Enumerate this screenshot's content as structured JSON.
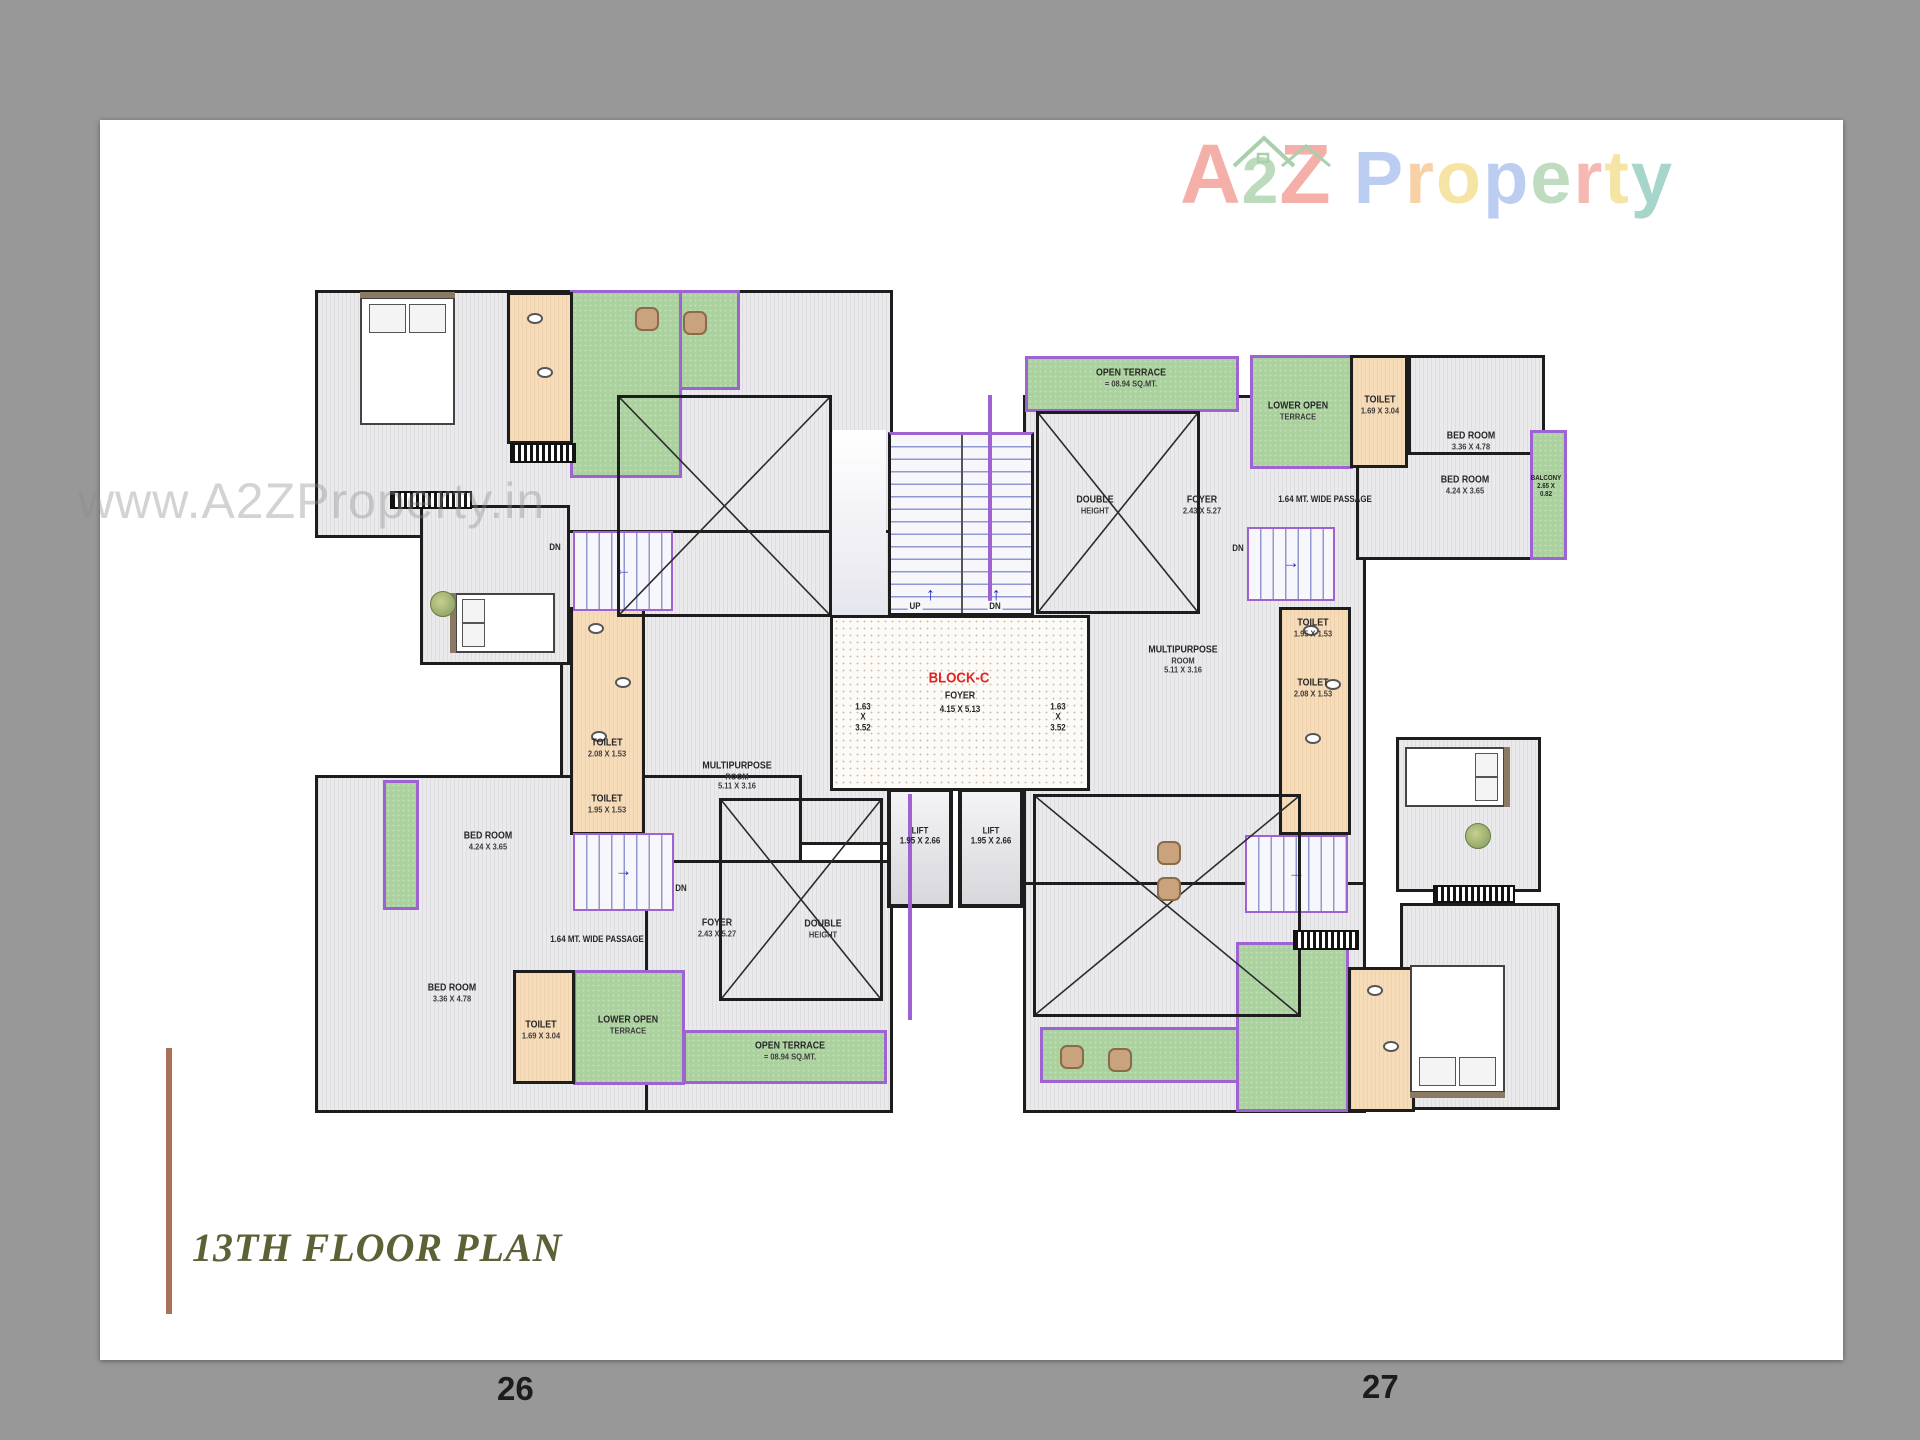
{
  "page": {
    "watermark": "www.A2ZProperty.in",
    "title": "13TH FLOOR PLAN",
    "page_number_left": "26",
    "page_number_right": "27",
    "title_color": "#5d6135",
    "accent_line_color": "#a8715a",
    "logo": {
      "word1": [
        {
          "ch": "A",
          "c": "#f4afa9"
        },
        {
          "ch": "2",
          "c": "#bcdabd",
          "mid": true
        },
        {
          "ch": "Z",
          "c": "#f4afa9"
        }
      ],
      "word2": [
        {
          "ch": "P",
          "c": "#bccdf2"
        },
        {
          "ch": "r",
          "c": "#f8d2a6"
        },
        {
          "ch": "o",
          "c": "#f6e4a4"
        },
        {
          "ch": "p",
          "c": "#bccdf2"
        },
        {
          "ch": "e",
          "c": "#bfdcc0"
        },
        {
          "ch": "r",
          "c": "#f6b8b3"
        },
        {
          "ch": "t",
          "c": "#f6e4a4"
        },
        {
          "ch": "y",
          "c": "#a6d5cb"
        }
      ],
      "house_color": "#aacfab"
    }
  },
  "plan": {
    "block_name": "BLOCK-C",
    "accent_purple": "#9e63d3",
    "red": "#e02420",
    "regions": [
      {
        "n": "unit-a-floor",
        "t": "floor",
        "x": 10,
        "y": 5,
        "w": 578,
        "h": 248
      },
      {
        "n": "unit-c-upper-floor",
        "t": "floor",
        "x": 255,
        "y": 245,
        "w": 335,
        "h": 315
      },
      {
        "n": "unit-c-floor",
        "t": "floor",
        "x": 10,
        "y": 490,
        "w": 487,
        "h": 338
      },
      {
        "n": "unit-c-east-floor",
        "t": "floor",
        "x": 340,
        "y": 575,
        "w": 248,
        "h": 253
      },
      {
        "n": "unit-b-floor",
        "t": "floor",
        "x": 718,
        "y": 110,
        "w": 343,
        "h": 492
      },
      {
        "n": "unit-d-floor",
        "t": "floor",
        "x": 718,
        "y": 597,
        "w": 343,
        "h": 231
      },
      {
        "n": "bedroom-424-b-floor",
        "t": "floor",
        "x": 1051,
        "y": 150,
        "w": 178,
        "h": 125
      },
      {
        "n": "bedroom-336-b-floor",
        "t": "floor",
        "x": 1103,
        "y": 70,
        "w": 137,
        "h": 100
      },
      {
        "n": "unit-d-bedroom-floor",
        "t": "floor",
        "x": 1095,
        "y": 618,
        "w": 160,
        "h": 207
      },
      {
        "n": "unit-d-mid-bedroom-floor",
        "t": "floor",
        "x": 1091,
        "y": 452,
        "w": 145,
        "h": 155
      },
      {
        "n": "unit-a-mid-bedroom-floor",
        "t": "floor",
        "x": 115,
        "y": 220,
        "w": 150,
        "h": 160
      },
      {
        "n": "terrace-a-band",
        "t": "terrace",
        "x": 265,
        "y": 5,
        "w": 170,
        "h": 100
      },
      {
        "n": "terrace-a-block",
        "t": "terrace",
        "x": 265,
        "y": 5,
        "w": 112,
        "h": 188
      },
      {
        "n": "open-terrace-b",
        "t": "terrace",
        "x": 720,
        "y": 71,
        "w": 214,
        "h": 56
      },
      {
        "n": "lower-open-terrace-b",
        "t": "terrace",
        "x": 945,
        "y": 70,
        "w": 103,
        "h": 114
      },
      {
        "n": "balcony-b",
        "t": "terrace",
        "x": 1225,
        "y": 145,
        "w": 37,
        "h": 130
      },
      {
        "n": "lower-open-terrace-c",
        "t": "terrace",
        "x": 268,
        "y": 685,
        "w": 112,
        "h": 115
      },
      {
        "n": "open-terrace-c",
        "t": "terrace",
        "x": 378,
        "y": 745,
        "w": 204,
        "h": 54
      },
      {
        "n": "terrace-d-band",
        "t": "terrace",
        "x": 735,
        "y": 742,
        "w": 202,
        "h": 56
      },
      {
        "n": "terrace-d-block",
        "t": "terrace",
        "x": 931,
        "y": 657,
        "w": 113,
        "h": 170
      },
      {
        "n": "balcony-c",
        "t": "terrace",
        "x": 78,
        "y": 495,
        "w": 36,
        "h": 130
      },
      {
        "n": "toilet-strip-a",
        "t": "toilet",
        "x": 202,
        "y": 7,
        "w": 66,
        "h": 152
      },
      {
        "n": "toilet-column-west",
        "t": "toilet",
        "x": 265,
        "y": 322,
        "w": 75,
        "h": 228
      },
      {
        "n": "toilet-column-east",
        "t": "toilet",
        "x": 974,
        "y": 322,
        "w": 72,
        "h": 228
      },
      {
        "n": "toilet-169-b",
        "t": "toilet",
        "x": 1045,
        "y": 70,
        "w": 58,
        "h": 113
      },
      {
        "n": "toilet-strip-d",
        "t": "toilet",
        "x": 1043,
        "y": 682,
        "w": 67,
        "h": 145
      },
      {
        "n": "toilet-169-c",
        "t": "toilet",
        "x": 208,
        "y": 685,
        "w": 62,
        "h": 114
      },
      {
        "n": "stair-landing",
        "t": "landing",
        "x": 527,
        "y": 145,
        "w": 54,
        "h": 184
      },
      {
        "n": "block-c-foyer",
        "t": "foyer",
        "x": 525,
        "y": 330,
        "w": 260,
        "h": 176
      },
      {
        "n": "central-staircase",
        "t": "stair-core",
        "x": 583,
        "y": 147,
        "w": 146,
        "h": 184
      },
      {
        "n": "lift-1",
        "t": "lift",
        "x": 582,
        "y": 503,
        "w": 66,
        "h": 120
      },
      {
        "n": "lift-2",
        "t": "lift",
        "x": 653,
        "y": 503,
        "w": 66,
        "h": 120
      },
      {
        "n": "stairs-a",
        "t": "stair",
        "x": 268,
        "y": 246,
        "w": 100,
        "h": 80,
        "dir": "left"
      },
      {
        "n": "stairs-b",
        "t": "stair",
        "x": 942,
        "y": 242,
        "w": 88,
        "h": 74,
        "dir": "right"
      },
      {
        "n": "stairs-c",
        "t": "stair",
        "x": 268,
        "y": 548,
        "w": 101,
        "h": 78,
        "dir": "right"
      },
      {
        "n": "stairs-d",
        "t": "stair",
        "x": 940,
        "y": 550,
        "w": 103,
        "h": 78,
        "dir": "right"
      },
      {
        "n": "double-height-a",
        "t": "cross",
        "x": 312,
        "y": 110,
        "w": 215,
        "h": 222
      },
      {
        "n": "double-height-b",
        "t": "cross",
        "x": 731,
        "y": 126,
        "w": 164,
        "h": 203
      },
      {
        "n": "double-height-c",
        "t": "cross",
        "x": 414,
        "y": 513,
        "w": 164,
        "h": 203
      },
      {
        "n": "double-height-d",
        "t": "cross",
        "x": 728,
        "y": 509,
        "w": 268,
        "h": 223
      },
      {
        "n": "purple-wall-1",
        "t": "pline",
        "x": 683,
        "y": 110,
        "w": 4,
        "h": 206
      },
      {
        "n": "purple-wall-2",
        "t": "pline",
        "x": 603,
        "y": 509,
        "w": 4,
        "h": 226
      }
    ],
    "labels": [
      {
        "n": "open-terrace-b-label",
        "x": 826,
        "y": 93,
        "lines": [
          "OPEN TERRACE",
          "= 08.94 SQ.MT."
        ]
      },
      {
        "n": "lower-open-terrace-b-label",
        "x": 993,
        "y": 126,
        "lines": [
          "LOWER OPEN",
          "TERRACE"
        ]
      },
      {
        "n": "toilet-169-b-label",
        "x": 1075,
        "y": 120,
        "lines": [
          "TOILET",
          "1.69 X 3.04"
        ]
      },
      {
        "n": "bedroom-336-b-label",
        "x": 1166,
        "y": 156,
        "lines": [
          "BED ROOM",
          "3.36 X 4.78"
        ]
      },
      {
        "n": "passage-b-label",
        "x": 1020,
        "y": 214,
        "lines": [
          "1.64 MT. WIDE PASSAGE"
        ],
        "s": 9
      },
      {
        "n": "double-height-b-label",
        "x": 790,
        "y": 220,
        "lines": [
          "DOUBLE",
          "HEIGHT"
        ]
      },
      {
        "n": "foyer-b-label",
        "x": 897,
        "y": 220,
        "lines": [
          "FOYER",
          "2.43 X 5.27"
        ]
      },
      {
        "n": "dn-b-label",
        "x": 933,
        "y": 263,
        "lines": [
          "DN"
        ],
        "s": 9
      },
      {
        "n": "bedroom-424-b-label",
        "x": 1160,
        "y": 200,
        "lines": [
          "BED ROOM",
          "4.24 X 3.65"
        ]
      },
      {
        "n": "balcony-b-label",
        "x": 1241,
        "y": 202,
        "lines": [
          "BALCONY",
          "2.65 X",
          "0.82"
        ],
        "s": 7
      },
      {
        "n": "toilet-195-b-label",
        "x": 1008,
        "y": 343,
        "lines": [
          "TOILET",
          "1.95 X 1.53"
        ]
      },
      {
        "n": "toilet-208-b-label",
        "x": 1008,
        "y": 403,
        "lines": [
          "TOILET",
          "2.08 X 1.53"
        ]
      },
      {
        "n": "multipurpose-b-label",
        "x": 878,
        "y": 375,
        "lines": [
          "MULTIPURPOSE",
          "ROOM",
          "5.11 X 3.16"
        ]
      },
      {
        "n": "dim-163-east-label",
        "x": 753,
        "y": 432,
        "lines": [
          "1.63",
          "X",
          "3.52"
        ],
        "s": 9
      },
      {
        "n": "dim-163-west-label",
        "x": 558,
        "y": 432,
        "lines": [
          "1.63",
          "X",
          "3.52"
        ],
        "s": 9
      },
      {
        "n": "block-c-label",
        "x": 654,
        "y": 393,
        "lines": [
          "BLOCK-C"
        ],
        "c": "#e02420",
        "s": 15
      },
      {
        "n": "block-c-foyer-label",
        "x": 655,
        "y": 411,
        "lines": [
          "FOYER"
        ]
      },
      {
        "n": "block-c-dim-label",
        "x": 655,
        "y": 424,
        "lines": [
          "4.15 X 5.13"
        ],
        "s": 9
      },
      {
        "n": "lift-1-label",
        "x": 615,
        "y": 551,
        "lines": [
          "LIFT",
          "1.95 X 2.66"
        ],
        "s": 9
      },
      {
        "n": "lift-2-label",
        "x": 686,
        "y": 551,
        "lines": [
          "LIFT",
          "1.95 X 2.66"
        ],
        "s": 9
      },
      {
        "n": "up-label",
        "x": 610,
        "y": 321,
        "lines": [
          "UP"
        ],
        "s": 9,
        "chip": 1
      },
      {
        "n": "dn-core-label",
        "x": 690,
        "y": 321,
        "lines": [
          "DN"
        ],
        "s": 9,
        "chip": 1
      },
      {
        "n": "toilet-208-c-label",
        "x": 302,
        "y": 463,
        "lines": [
          "TOILET",
          "2.08 X 1.53"
        ]
      },
      {
        "n": "toilet-195-c-label",
        "x": 302,
        "y": 519,
        "lines": [
          "TOILET",
          "1.95 X 1.53"
        ]
      },
      {
        "n": "multipurpose-c-label",
        "x": 432,
        "y": 491,
        "lines": [
          "MULTIPURPOSE",
          "ROOM",
          "5.11 X 3.16"
        ]
      },
      {
        "n": "bedroom-424-c-label",
        "x": 183,
        "y": 556,
        "lines": [
          "BED ROOM",
          "4.24 X 3.65"
        ]
      },
      {
        "n": "dn-c-label",
        "x": 376,
        "y": 603,
        "lines": [
          "DN"
        ],
        "s": 9
      },
      {
        "n": "passage-c-label",
        "x": 292,
        "y": 654,
        "lines": [
          "1.64 MT. WIDE PASSAGE"
        ],
        "s": 9
      },
      {
        "n": "bedroom-336-c-label",
        "x": 147,
        "y": 708,
        "lines": [
          "BED ROOM",
          "3.36 X 4.78"
        ]
      },
      {
        "n": "toilet-169-c-label",
        "x": 236,
        "y": 745,
        "lines": [
          "TOILET",
          "1.69 X 3.04"
        ]
      },
      {
        "n": "lower-open-terrace-c-label",
        "x": 323,
        "y": 740,
        "lines": [
          "LOWER OPEN",
          "TERRACE"
        ]
      },
      {
        "n": "foyer-c-label",
        "x": 412,
        "y": 643,
        "lines": [
          "FOYER",
          "2.43 X 5.27"
        ]
      },
      {
        "n": "double-height-c-label",
        "x": 518,
        "y": 644,
        "lines": [
          "DOUBLE",
          "HEIGHT"
        ]
      },
      {
        "n": "open-terrace-c-label",
        "x": 485,
        "y": 766,
        "lines": [
          "OPEN TERRACE",
          "= 08.94 SQ.MT."
        ]
      },
      {
        "n": "dn-a-label",
        "x": 250,
        "y": 262,
        "lines": [
          "DN"
        ],
        "s": 9
      }
    ],
    "furniture": [
      {
        "t": "bed",
        "n": "bed-unit-a",
        "x": 55,
        "y": 12,
        "w": 95,
        "h": 128,
        "p": "top"
      },
      {
        "t": "bed",
        "n": "bed-unit-d",
        "x": 1105,
        "y": 680,
        "w": 95,
        "h": 128,
        "p": "bottom"
      },
      {
        "t": "bed",
        "n": "bed-unit-a-mid",
        "x": 150,
        "y": 308,
        "w": 100,
        "h": 60,
        "p": "left"
      },
      {
        "t": "bed",
        "n": "bed-unit-d-mid",
        "x": 1100,
        "y": 462,
        "w": 100,
        "h": 60,
        "p": "right"
      },
      {
        "t": "wardrobe",
        "n": "wardrobe-a1",
        "x": 85,
        "y": 206,
        "w": 82,
        "h": 18
      },
      {
        "t": "wardrobe",
        "n": "wardrobe-a2",
        "x": 205,
        "y": 158,
        "w": 66,
        "h": 20
      },
      {
        "t": "wardrobe",
        "n": "wardrobe-d1",
        "x": 988,
        "y": 645,
        "w": 66,
        "h": 20
      },
      {
        "t": "wardrobe",
        "n": "wardrobe-d2",
        "x": 1128,
        "y": 600,
        "w": 82,
        "h": 18
      },
      {
        "t": "chair",
        "n": "chair-terrace-a-1",
        "x": 330,
        "y": 22
      },
      {
        "t": "chair",
        "n": "chair-terrace-a-2",
        "x": 378,
        "y": 26
      },
      {
        "t": "chair",
        "n": "chair-terrace-d-1",
        "x": 755,
        "y": 760
      },
      {
        "t": "chair",
        "n": "chair-terrace-d-2",
        "x": 803,
        "y": 763
      },
      {
        "t": "chair",
        "n": "chair-hall-d-1",
        "x": 852,
        "y": 556
      },
      {
        "t": "chair",
        "n": "chair-hall-d-2",
        "x": 852,
        "y": 592
      },
      {
        "t": "plant",
        "n": "plant-a",
        "x": 125,
        "y": 306
      },
      {
        "t": "plant",
        "n": "plant-d",
        "x": 1160,
        "y": 538
      },
      {
        "t": "fixture",
        "n": "wc-west-1",
        "x": 283,
        "y": 338
      },
      {
        "t": "fixture",
        "n": "wc-west-2",
        "x": 310,
        "y": 392
      },
      {
        "t": "fixture",
        "n": "wc-west-3",
        "x": 286,
        "y": 446
      },
      {
        "t": "fixture",
        "n": "wc-east-1",
        "x": 998,
        "y": 340
      },
      {
        "t": "fixture",
        "n": "wc-east-2",
        "x": 1020,
        "y": 394
      },
      {
        "t": "fixture",
        "n": "wc-east-3",
        "x": 1000,
        "y": 448
      },
      {
        "t": "fixture",
        "n": "wc-a-1",
        "x": 222,
        "y": 28
      },
      {
        "t": "fixture",
        "n": "wc-a-2",
        "x": 232,
        "y": 82
      },
      {
        "t": "fixture",
        "n": "wc-d-1",
        "x": 1062,
        "y": 700
      },
      {
        "t": "fixture",
        "n": "wc-d-2",
        "x": 1078,
        "y": 756
      }
    ]
  }
}
